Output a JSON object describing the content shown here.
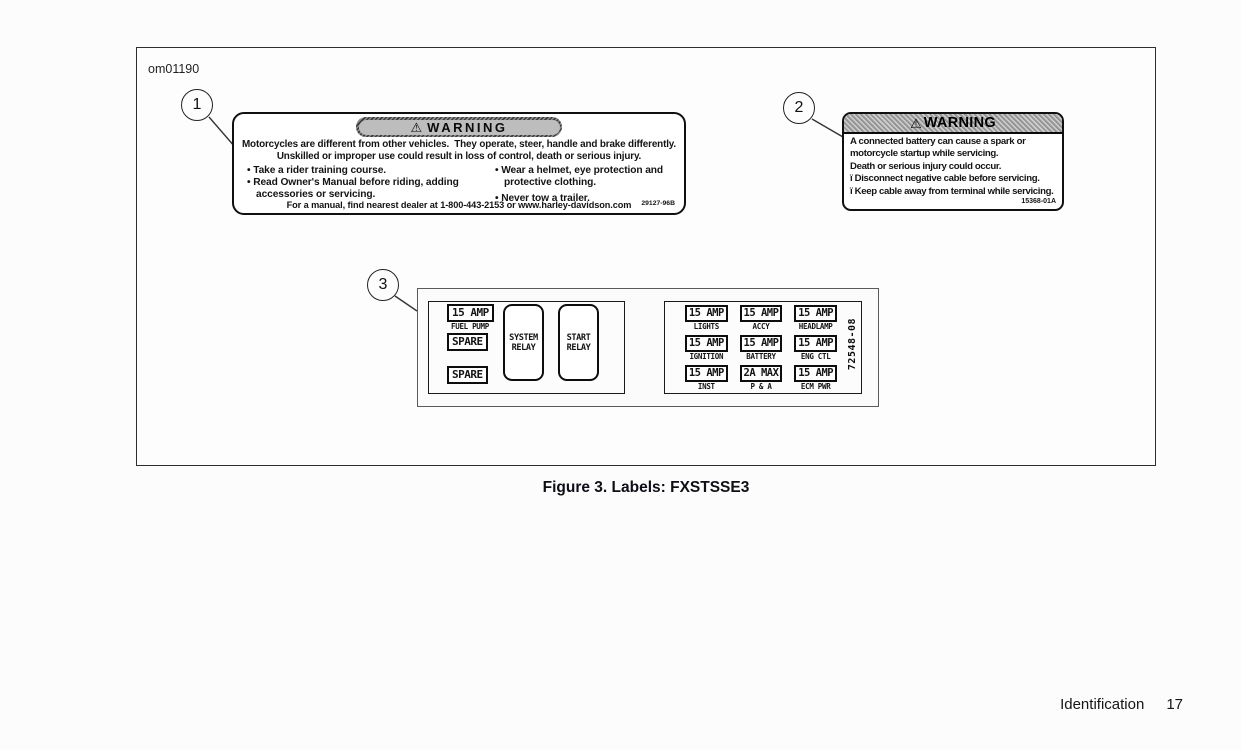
{
  "page": {
    "code": "om01190",
    "caption": "Figure 3. Labels: FXSTSSE3",
    "footer_section": "Identification",
    "footer_page": "17"
  },
  "callouts": {
    "one": "1",
    "two": "2",
    "three": "3"
  },
  "warning_label_1": {
    "icon": "⚠",
    "title": "WARNING",
    "line1": "Motorcycles are different from other vehicles.  They operate, steer, handle and brake differently.",
    "line2": "Unskilled or improper use could result in loss of control, death or serious injury.",
    "bullet_marker": "•",
    "bullets_left": [
      "Take a rider training course.",
      "Read Owner's Manual before riding, adding accessories or servicing."
    ],
    "bullets_right": [
      "Wear a helmet, eye protection and protective clothing.",
      "Never tow a trailer."
    ],
    "footer": "For a manual, find nearest dealer at 1-800-443-2153 or www.harley-davidson.com",
    "part_number": "29127-96B"
  },
  "warning_label_2": {
    "icon": "⚠",
    "title": "WARNING",
    "para1": "A connected battery can cause a spark or motorcycle startup while servicing.",
    "para2": "Death or serious injury could occur.",
    "bullet_marker": "ï",
    "bullets": [
      "Disconnect negative cable before servicing.",
      "Keep cable away from terminal while servicing."
    ],
    "part_number": "15368-01A"
  },
  "fuse_label": {
    "left_panel": {
      "fuse1_value": "15 AMP",
      "fuse1_name": "FUEL PUMP",
      "spare1": "SPARE",
      "spare2": "SPARE",
      "relay1_line1": "SYSTEM",
      "relay1_line2": "RELAY",
      "relay2_line1": "START",
      "relay2_line2": "RELAY"
    },
    "right_panel": {
      "cells": [
        {
          "value": "15 AMP",
          "name": "LIGHTS"
        },
        {
          "value": "15 AMP",
          "name": "ACCY"
        },
        {
          "value": "15 AMP",
          "name": "HEADLAMP"
        },
        {
          "value": "15 AMP",
          "name": "IGNITION"
        },
        {
          "value": "15 AMP",
          "name": "BATTERY"
        },
        {
          "value": "15 AMP",
          "name": "ENG CTL"
        },
        {
          "value": "15 AMP",
          "name": "INST"
        },
        {
          "value": "2A MAX",
          "name": "P & A"
        },
        {
          "value": "15 AMP",
          "name": "ECM PWR"
        }
      ],
      "part_number": "72548-08"
    }
  }
}
